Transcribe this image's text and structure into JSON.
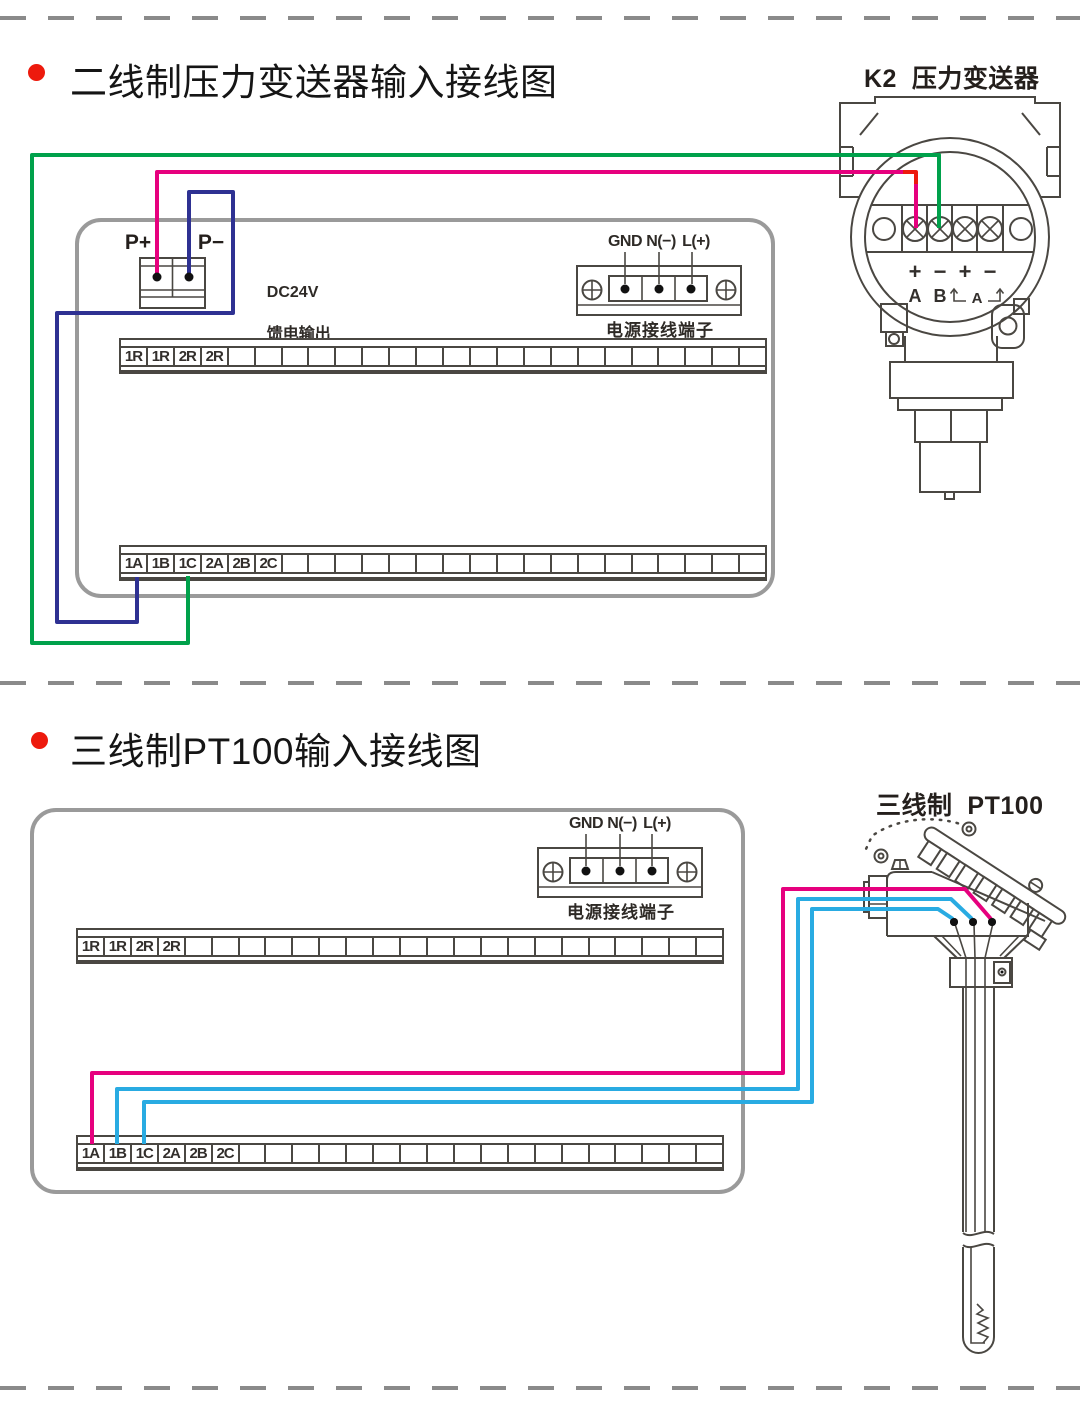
{
  "colors": {
    "line": "#4a4742",
    "box_gray": "#9a9a9a",
    "dash_gray": "#8a8a8a",
    "green": "#00a14b",
    "magenta": "#e6007e",
    "red": "#ed1a0d",
    "navy": "#2e3192",
    "light_blue": "#29abe2",
    "dot_black": "#111111"
  },
  "section1": {
    "title": "二线制压力变送器输入接线图",
    "device_label": "K2  压力变送器",
    "p_plus": "P+",
    "p_minus": "P−",
    "feed_line1": "DC24V",
    "feed_line2": "馈电输出",
    "power_labels": [
      "GND",
      "N(−)",
      "L(+)"
    ],
    "power_caption": "电源接线端子",
    "strip_top": {
      "cells": 24,
      "labels": [
        "1R",
        "1R",
        "2R",
        "2R"
      ]
    },
    "strip_bottom": {
      "cells": 24,
      "labels": [
        "1A",
        "1B",
        "1C",
        "2A",
        "2B",
        "2C"
      ]
    },
    "transmitter_terminals": {
      "signs": [
        "+",
        "−",
        "+",
        "−"
      ],
      "a": "A",
      "b": "B",
      "a2": "A"
    }
  },
  "section2": {
    "title": "三线制PT100输入接线图",
    "device_label": "三线制  PT100",
    "power_labels": [
      "GND",
      "N(−)",
      "L(+)"
    ],
    "power_caption": "电源接线端子",
    "strip_top": {
      "cells": 24,
      "labels": [
        "1R",
        "1R",
        "2R",
        "2R"
      ]
    },
    "strip_bottom": {
      "cells": 24,
      "labels": [
        "1A",
        "1B",
        "1C",
        "2A",
        "2B",
        "2C"
      ]
    }
  }
}
